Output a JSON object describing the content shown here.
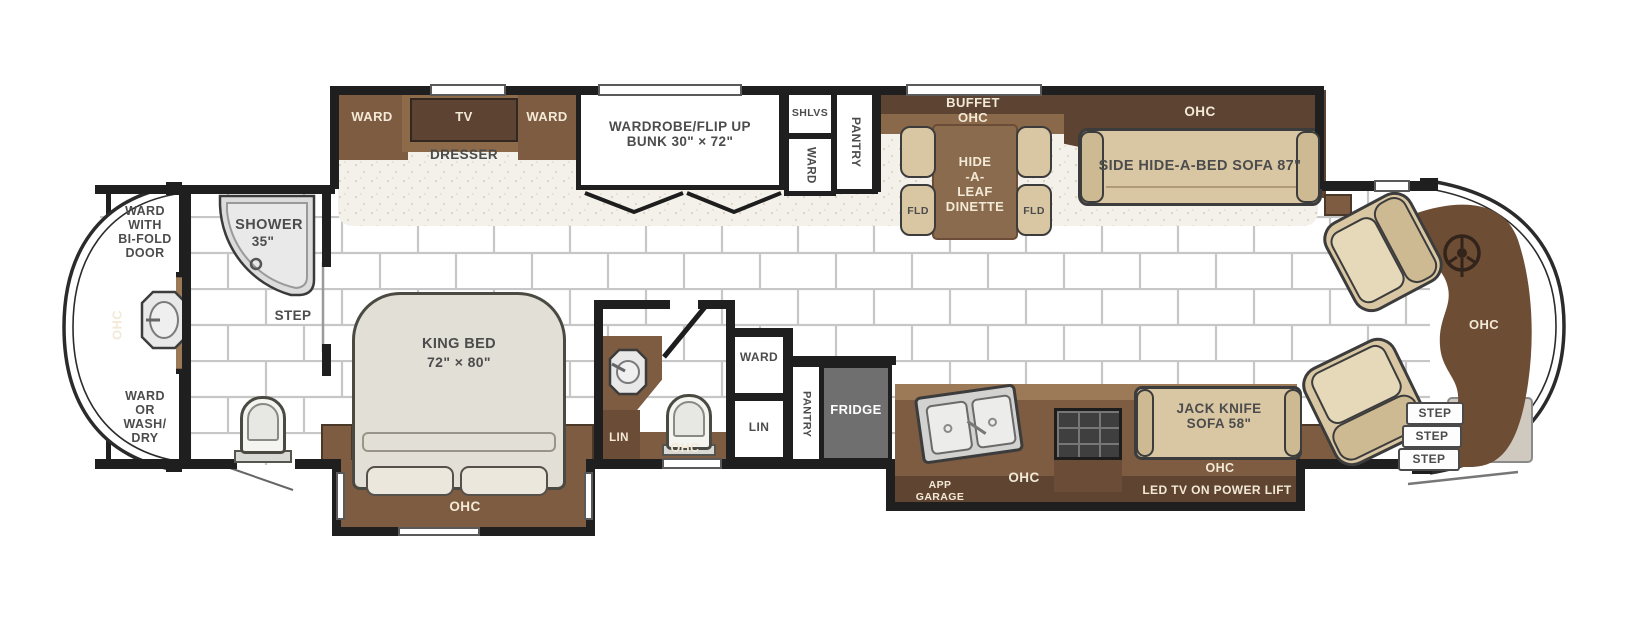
{
  "plan_type": "motorhome floor plan",
  "colors": {
    "wall": "#1f1f1f",
    "cabinet": "#7d5c41",
    "cabinet_dark": "#5d4331",
    "cabinet_light": "#9c7a58",
    "upholstery_tan": "#d9c7a4",
    "fridge_gray": "#6f6f6f",
    "label_gray": "#4c4c4c",
    "label_cream": "#f3e9d7",
    "tile_line": "#c7c7c7",
    "carpet": "#f4f1ea"
  },
  "rear": {
    "ward_bifold": "WARD\nWITH\nBI-FOLD\nDOOR",
    "ohc": "OHC",
    "ward_washdry": "WARD\nOR\nWASH/\nDRY"
  },
  "rear_bath": {
    "shower": "SHOWER",
    "shower_size": "35\"",
    "step": "STEP"
  },
  "bedroom": {
    "ward_left": "WARD",
    "tv": "TV",
    "dresser": "DRESSER",
    "ward_right": "WARD",
    "bunk": "WARDROBE/FLIP UP\nBUNK 30\" × 72\"",
    "king_bed": "KING BED",
    "king_size": "72\" × 80\"",
    "ohc": "OHC"
  },
  "closets": {
    "shlvs": "SHLVS",
    "ward": "WARD",
    "pantry": "PANTRY"
  },
  "dinette": {
    "buffet": "BUFFET\nOHC",
    "table": "HIDE\n-A-\nLEAF\nDINETTE",
    "fld_left": "FLD",
    "fld_right": "FLD"
  },
  "living": {
    "ohc": "OHC",
    "sofa": "SIDE HIDE-A-BED SOFA 87\""
  },
  "mid_bath": {
    "lin_left": "LIN",
    "ohc": "OHC",
    "ward": "WARD",
    "lin_right": "LIN",
    "pantry": "PANTRY"
  },
  "kitchen": {
    "fridge": "FRIDGE",
    "app_garage": "APP\nGARAGE",
    "ohc": "OHC",
    "jack_knife": "JACK KNIFE\nSOFA 58\"",
    "ohc_sofa": "OHC",
    "led_tv": "LED TV ON POWER LIFT"
  },
  "front": {
    "ohc": "OHC",
    "steps": [
      "STEP",
      "STEP",
      "STEP"
    ]
  }
}
